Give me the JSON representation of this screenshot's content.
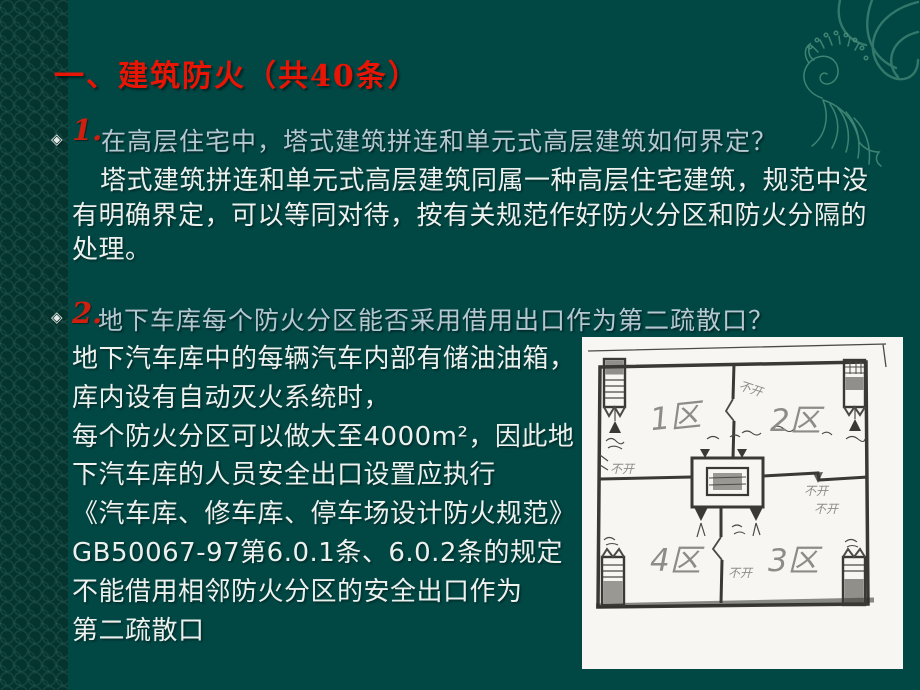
{
  "slide": {
    "title": "一、建筑防火（共40条）",
    "bullet_glyph": "◈",
    "questions": [
      {
        "number": "1.",
        "question": "在高层住宅中，塔式建筑拼连和单元式高层建筑如何界定？",
        "answer_lines": [
          "塔式建筑拼连和单元式高层建筑同属一种高层住宅建筑，规范中没",
          "有明确界定，可以等同对待，按有关规范作好防火分区和防火分隔的",
          "处理。"
        ]
      },
      {
        "number": "2.",
        "question": "地下车库每个防火分区能否采用借用出口作为第二疏散口？",
        "answer_lines": [
          "地下汽车库中的每辆汽车内部有储油油箱，",
          "库内设有自动灭火系统时，",
          "每个防火分区可以做大至4000m²，因此地",
          "下汽车库的人员安全出口设置应执行",
          "《汽车库、修车库、停车场设计防火规范》",
          "GB50067-97第6.0.1条、6.0.2条的规定",
          "不能借用相邻防火分区的安全出口作为",
          "第二疏散口"
        ]
      }
    ],
    "diagram": {
      "type": "hand-drawn floor plan sketch",
      "zone_labels": [
        "1区",
        "2区",
        "3区",
        "4区"
      ],
      "annotations": {
        "no_open": "不开"
      }
    },
    "colors": {
      "background": "#014845",
      "left_strip": "#05332e",
      "title_red": "#e81505",
      "number_red": "#d01f0e",
      "question_text": "#b5c8d2",
      "answer_text": "#edf1ee",
      "ornament_green": "#4f937e"
    }
  }
}
